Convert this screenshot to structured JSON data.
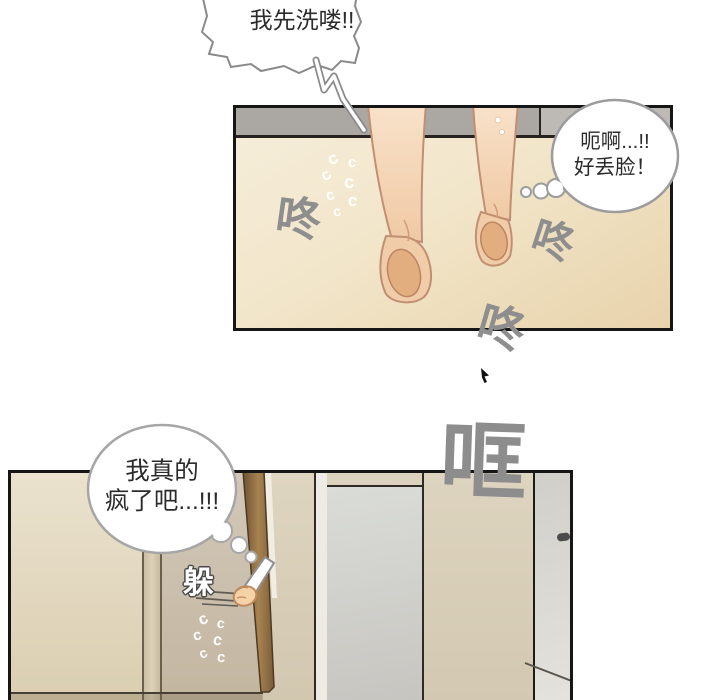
{
  "page": {
    "background": "#ffffff",
    "type": "comic-page",
    "panel_count": 2
  },
  "speech_bubble": {
    "text": "我先洗喽!!"
  },
  "thought_bubble_top": {
    "line1": "呃啊...!!",
    "line2": "好丢脸！"
  },
  "thought_bubble_bottom": {
    "line1": "我真的",
    "line2": "疯了吧...!!!"
  },
  "sfx": {
    "dong": "咚",
    "kuang": "哐",
    "duo": "躲",
    "motion_glyph": "c"
  },
  "colors": {
    "panel_border": "#161616",
    "sfx_gray": "#8e8e8e",
    "wall_band_gray": "#aba8a3",
    "floor_beige": "#eee0bf",
    "skin": "#f4d6b4",
    "sole": "#e2ae80",
    "door_brown": "#7a5c3a",
    "bubble_outline": "#9c9c9c"
  }
}
